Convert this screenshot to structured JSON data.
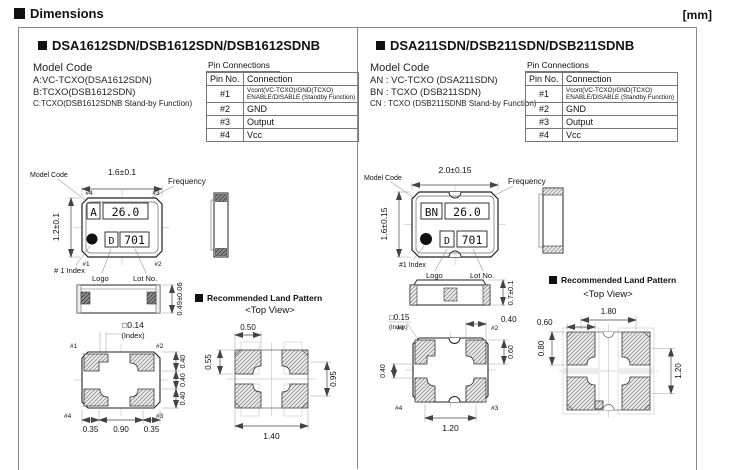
{
  "page": {
    "title": "Dimensions",
    "unit": "[mm]"
  },
  "pin_table": {
    "title": "Pin Connections",
    "col_pin": "Pin No.",
    "col_conn": "Connection",
    "rows": [
      {
        "pin": "#1",
        "conn": "Vcont(VC-TCXO)/GND(TCXO)",
        "conn2": "ENABLE/DISABLE (Standby Function)"
      },
      {
        "pin": "#2",
        "conn": "GND"
      },
      {
        "pin": "#3",
        "conn": "Output"
      },
      {
        "pin": "#4",
        "conn": "Vcc"
      }
    ]
  },
  "left": {
    "title": "DSA1612SDN/DSB1612SDN/DSB1612SDNB",
    "model_code": {
      "heading": "Model Code",
      "line_a": "A:VC-TCXO(DSA1612SDN)",
      "line_b": "B:TCXO(DSB1612SDN)",
      "line_c": "C:TCXO(DSB1612SDNB Stand-by Function)"
    },
    "top_view": {
      "dim_width": "1.6±0.1",
      "dim_height": "1.2±0.1",
      "callout_model": "Model Code",
      "callout_freq": "Frequency",
      "pin_tl": "#4",
      "pin_tr": "#3",
      "pin_bl": "#1",
      "pin_br": "#2",
      "mark_model": "A",
      "mark_freq": "26.0",
      "mark_logo": "D",
      "mark_lot": "701",
      "label_index": "# 1 Index",
      "label_logo": "Logo",
      "label_lot": "Lot No."
    },
    "front_view": {
      "dim_height": "0.49±0.06"
    },
    "bottom_view": {
      "dim_index": "□0.14",
      "index_note": "(Index)",
      "pin_tl": "#1",
      "pin_tr": "#2",
      "pin_bl": "#4",
      "pin_br": "#3",
      "dim_r1": "0.40",
      "dim_r2": "0.40",
      "dim_r3": "0.40",
      "dim_b1": "0.35",
      "dim_b2": "0.90",
      "dim_b3": "0.35"
    },
    "land": {
      "title": "Recommended Land Pattern",
      "subtitle": "<Top View>",
      "dim_top": "0.50",
      "dim_left": "0.55",
      "dim_right": "0.95",
      "dim_bottom": "1.40"
    }
  },
  "right": {
    "title": "DSA211SDN/DSB211SDN/DSB211SDNB",
    "model_code": {
      "heading": "Model Code",
      "line_a": "AN : VC-TCXO (DSA211SDN)",
      "line_b": "BN : TCXO (DSB211SDN)",
      "line_c": "CN : TCXO (DSB211SDNB Stand-by Function)"
    },
    "top_view": {
      "dim_width": "2.0±0.15",
      "dim_height": "1.6±0.15",
      "callout_model": "Model Code",
      "callout_freq": "Frequency",
      "mark_model": "BN",
      "mark_freq": "26.0",
      "mark_logo": "D",
      "mark_lot": "701",
      "label_index": "#1 Index",
      "label_logo": "Logo",
      "label_lot": "Lot No."
    },
    "front_view": {
      "dim_height": "0.7±0.1"
    },
    "bottom_view": {
      "dim_index": "□0.15",
      "index_note": "(Index)",
      "pin_tl": "#1",
      "pin_tr": "#2",
      "pin_bl": "#4",
      "pin_br": "#3",
      "dim_top_right": "0.40",
      "dim_left": "0.40",
      "dim_right": "0.60",
      "dim_bottom": "1.20"
    },
    "land": {
      "title": "Recommended Land Pattern",
      "subtitle": "<Top View>",
      "dim_top": "1.80",
      "dim_top_left": "0.60",
      "dim_left": "0.80",
      "dim_right": "1.20"
    }
  }
}
